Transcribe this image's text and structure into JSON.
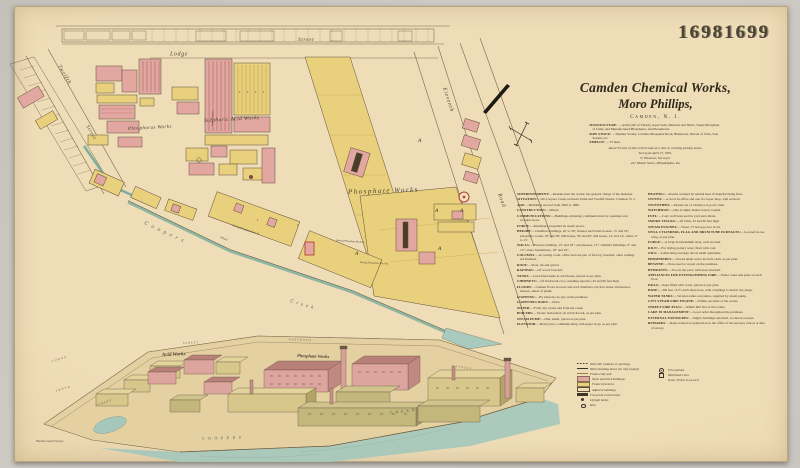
{
  "sheet_number": "16981699",
  "colors": {
    "paper": "#eedcb6",
    "brick_pink": "#e2a7a0",
    "frame_yellow": "#e9d07d",
    "creek_teal": "#7fae9c",
    "ink": "#332c1f",
    "tank_red": "#b5433a"
  },
  "title": {
    "line1": "Camden Chemical Works,",
    "line2": "Moro Phillips,",
    "location": "Camden, N. J.",
    "details": [
      {
        "head": "MANUFACTURE:",
        "text": "—Acids (Oil of Vitriol), Aqua Soda, Muriatic and Nitric, Super-Phosphate of Lime, and Manufactured Phosphates, and Phosphorus."
      },
      {
        "head": "RAW STOCK:",
        "text": "—Sulphur Stones, Carolina Phosphate Rock, Brimstone, Nitrate of Soda, Salt, Kaolin, etc."
      },
      {
        "head": "EMPLOY:",
        "text": "—75 men."
      }
    ],
    "note": "About 50 tons of lime will be kept at a time in working picking house.",
    "surveyed": "Surveyed April 27, 1891.",
    "surveyor": "E. Hexamer, Surveyor.",
    "address": "427 Walnut Street, Philadelphia, Pa."
  },
  "description": {
    "left": [
      {
        "head": "SUPERINTENDENT:",
        "text": "—Resides near the works; has general charge of the business."
      },
      {
        "head": "SITUATION:",
        "text": "—On Coopers Creek, between Tenth and Twelfth Streets, Camden, N. J."
      },
      {
        "head": "AGE:",
        "text": "—Buildings erected from 1850 to 1882."
      },
      {
        "head": "CONSTRUCTION:",
        "text": "—Mixed."
      },
      {
        "head": "COMMUNICATIONS:",
        "text": "—Buildings adjoining; communication by openings and wooden doors."
      },
      {
        "head": "FORCE:",
        "text": "—Machinery propelled by steam power."
      },
      {
        "head": "HEIGHT:",
        "text": "—Chamber buildings, 20' to 30'; furnace and boiler houses, 15' and 18'; phosphate works, 18' and 28'; mill house, 30' and 40'; still house, 12' and 14'; others, 9' to 15'."
      },
      {
        "head": "WALLS:",
        "text": "—Furnace building, 13″ and 18″; storehouses, 13″; chamber buildings, 9″ and 13″; stone foundations, 18″ and 24″."
      },
      {
        "head": "COLUMNS:",
        "text": "—In casting room, office and one part of factory; boarded; other ceilings not finished."
      },
      {
        "head": "ROOF:",
        "text": "—Slate, tin and gravel."
      },
      {
        "head": "RAFTERS:",
        "text": "—Of wood; boarded."
      },
      {
        "head": "TANKS:",
        "text": "—Lead-lined tanks in acid house, placed as per plan."
      },
      {
        "head": "CHIMNEYS:",
        "text": "—Of brickwork; two, standing separate; 45 and 60 feet high."
      },
      {
        "head": "FLOORS:",
        "text": "—Cement floors in retort and acid chambers; brick in boiler and furnace houses; others of plank."
      },
      {
        "head": "LIGHTING:",
        "text": "—By lanterns; no gas on the premises."
      },
      {
        "head": "LIGHTNING RODS:",
        "text": "—None."
      },
      {
        "head": "WATER:",
        "text": "—From city works and from the creek."
      },
      {
        "head": "BOILERS:",
        "text": "—Seven; horizontal; set in brickwork, as per plan."
      },
      {
        "head": "STEAM PUMP:",
        "text": "—One; small, placed as per plan."
      },
      {
        "head": "ELEVATOR:",
        "text": "—Belt power, communicating with upper story, as per plan."
      }
    ],
    "right": [
      {
        "head": "HEATING:",
        "text": "—Rooms warmed by natural heat of manufacturing fires."
      },
      {
        "head": "STOVES:",
        "text": "—A stove in office and one in cooper shop, well secured."
      },
      {
        "head": "STOVEPIPES:",
        "text": "—Passed out of windows in good order."
      },
      {
        "head": "WATCHMAN:",
        "text": "—One at night; makes hourly rounds."
      },
      {
        "head": "FUEL:",
        "text": "—Coal; well bestowed in yard and cellars."
      },
      {
        "head": "SMOKE STACKS:",
        "text": "—Of brick, 45 and 60 feet high."
      },
      {
        "head": "STEAM ENGINES:",
        "text": "—Three; 75 horse-power in all."
      },
      {
        "head": "STILL CYLINDERS, FLAG AND DRUM TUBE FURNACES:",
        "text": "—Located in one wing, as per plan."
      },
      {
        "head": "FORGE:",
        "text": "—A forge in blacksmith shop, well secured."
      },
      {
        "head": "KILN:",
        "text": "—For drying pottery ware; fired with coal."
      },
      {
        "head": "OILS:",
        "text": "—Lubricating and sign oils in small quantities."
      },
      {
        "head": "PHOSPHORUS:",
        "text": "—Stored under water in brick vault, as per plan."
      },
      {
        "head": "BENZINE:",
        "text": "—None used or stored on the premises."
      },
      {
        "head": "HYDRANTS:",
        "text": "—Two in the yard, with hose attached."
      },
      {
        "head": "APPLIANCES FOR EXTINGUISHING FIRE:",
        "text": "—Water casks and pails on each floor."
      },
      {
        "head": "PAILS:",
        "text": "—Kept filled with water, placed as per plan."
      },
      {
        "head": "HOSE:",
        "text": "—300 feet of 2½-inch linen hose, with couplings to match city plugs."
      },
      {
        "head": "WATER TANKS:",
        "text": "—Wooden tanks on trestles, supplied by steam pump."
      },
      {
        "head": "CITY STEAM FIRE ENGINE:",
        "text": "—Within one mile of the works."
      },
      {
        "head": "STREET FIRE PLUG:",
        "text": "—Within 600 feet of the works."
      },
      {
        "head": "CARE IN MANAGEMENT:",
        "text": "—Good order throughout the premises."
      },
      {
        "head": "EXTERNAL EXPOSURES:",
        "text": "—Slight; buildings detached, as shown on plan."
      },
      {
        "head": "REMARKS:",
        "text": "—Rates treated on application at the office of the surveys; risk as at date of survey."
      }
    ]
  },
  "legend": {
    "left": [
      {
        "sym": "dash",
        "label": "Wall with windows or openings."
      },
      {
        "sym": "coped",
        "label": "Wall extending above the roof (coped)."
      },
      {
        "sym": "frame",
        "label": "Frame-clad wall."
      },
      {
        "sym": "pink",
        "label": "Stone and brick buildings."
      },
      {
        "sym": "yellow",
        "label": "Frame structures."
      },
      {
        "sym": "outline",
        "label": "Adjacent buildings."
      },
      {
        "sym": "bar",
        "label": "Fire-proof construction."
      },
      {
        "sym": "dotf",
        "label": "Upright boiler."
      },
      {
        "sym": "doto",
        "label": "Kiln."
      }
    ],
    "right": [
      {
        "sym": "hyd",
        "label": "Fire hydrant."
      },
      {
        "sym": "flag",
        "label": "Watchman's box."
      },
      {
        "sym": "scale",
        "label": "Scale, 50 feet to an inch."
      }
    ]
  },
  "map": {
    "street_top": "Street",
    "street_lodge": "Lodge",
    "street_twelfth": "Twelfth",
    "street_twelfth_2": "Street",
    "street_eleventh": "Eleventh",
    "street_road": "Road",
    "creek_upper": "Coopers",
    "creek_lower": "Creek",
    "wharf": "Wharf",
    "area_phosphorus": "Phosphorus Works",
    "area_sulphuric": "Sulphuric Acid Works",
    "area_phosphate": "Phosphate Works",
    "ann_chambers": "Acid Chambers",
    "ann_storing": "Storing Phosphate Rock &c.",
    "ann_drying": "Drying Phosphate Rock &c.",
    "mark_a": "A",
    "mark_1": "1"
  },
  "birdseye": {
    "street_lodge": "LODGE",
    "street_tenth": "TENTH",
    "street_1": "STREET",
    "street_2": "STREET",
    "street_3": "STREET",
    "street_eleventh": "ELEVENTH",
    "label_acid": "Acid Works",
    "label_phosphate": "Phosphate Works",
    "creek_upper": "COOPERS",
    "creek_lower": "CREEK",
    "imprint": "Hexamer General Surveys."
  }
}
